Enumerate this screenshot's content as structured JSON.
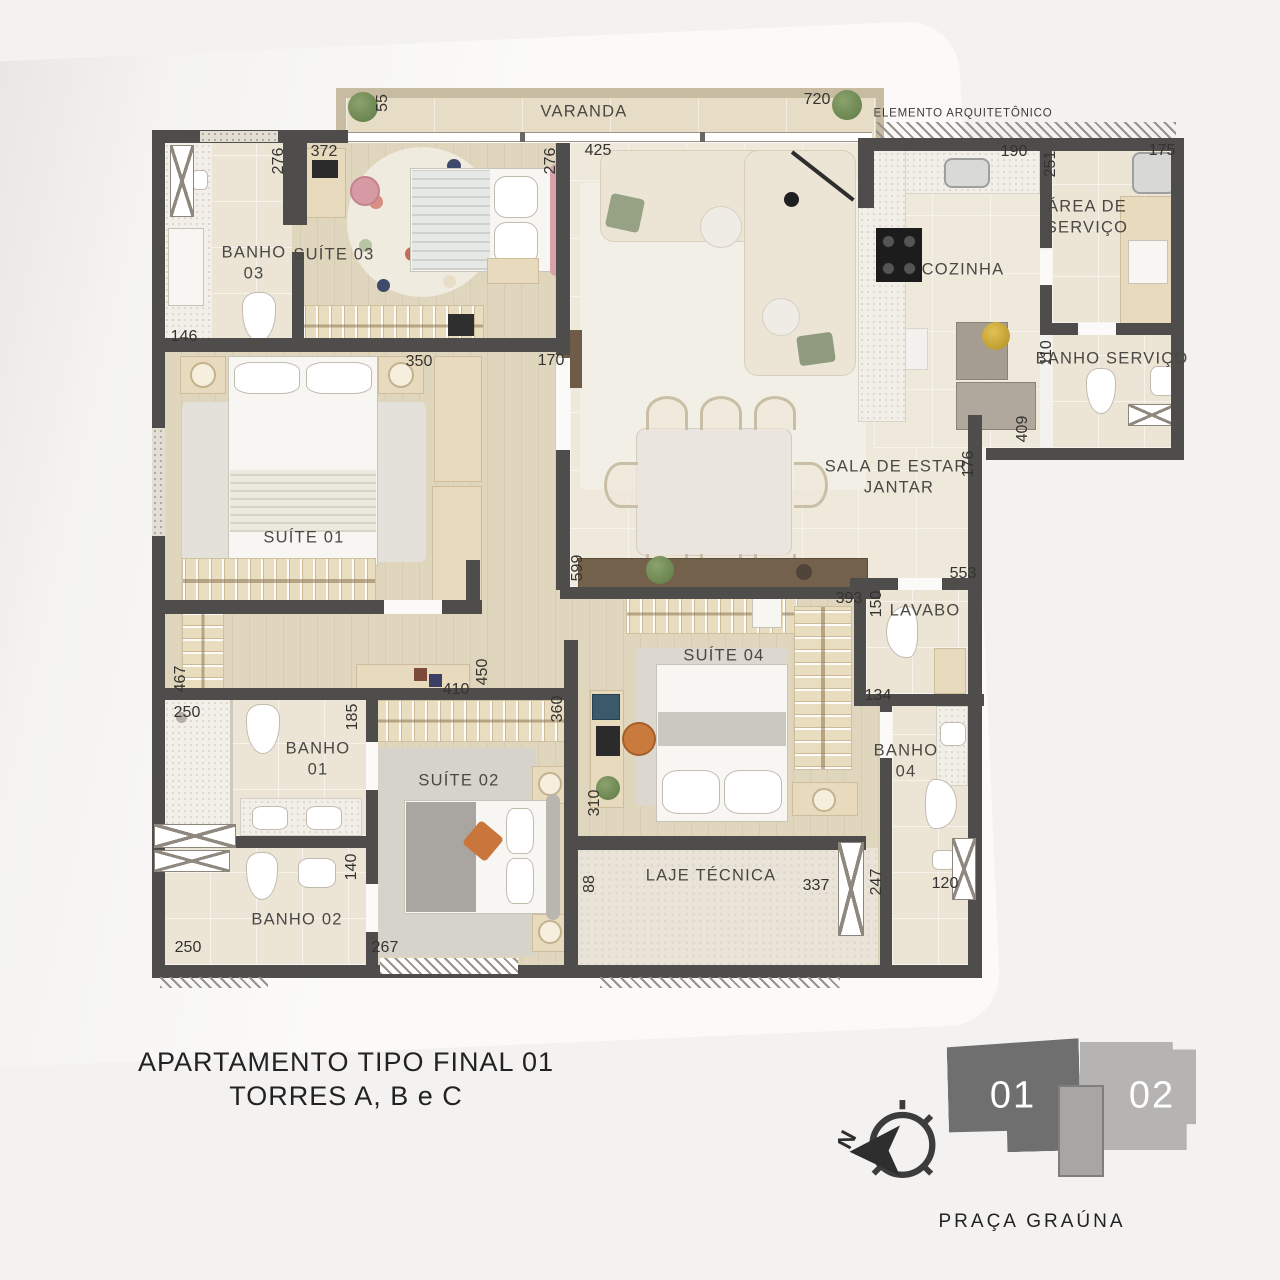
{
  "title": {
    "line1": "APARTAMENTO TIPO FINAL 01",
    "line2": "TORRES A, B e C"
  },
  "legend": {
    "caption": "PRAÇA GRAÚNA",
    "north_label": "N",
    "units": [
      {
        "id": "01"
      },
      {
        "id": "02"
      }
    ]
  },
  "colors": {
    "wall": "#4f4d4b",
    "wood_floor": "#e0d5bd",
    "tile_floor": "#ece5d5",
    "unit1": "#6f6f6f",
    "unit2": "#b5b4b3",
    "accent_pink": "#d79aa4",
    "accent_orange": "#c8763c"
  },
  "plan": {
    "room_labels": [
      {
        "name": "varanda",
        "lines": [
          "VARANDA"
        ],
        "x": 584,
        "y": 112
      },
      {
        "name": "elemento-arquitetonico",
        "lines": [
          "ELEMENTO ARQUITETÔNICO"
        ],
        "x": 963,
        "y": 114,
        "small": true
      },
      {
        "name": "banho-03",
        "lines": [
          "BANHO",
          "03"
        ],
        "x": 254,
        "y": 264
      },
      {
        "name": "suite-03",
        "lines": [
          "SUÍTE 03"
        ],
        "x": 334,
        "y": 255
      },
      {
        "name": "cozinha",
        "lines": [
          "COZINHA"
        ],
        "x": 963,
        "y": 270
      },
      {
        "name": "area-de-servico",
        "lines": [
          "ÁREA DE",
          "SERVIÇO"
        ],
        "x": 1087,
        "y": 218
      },
      {
        "name": "banho-servico",
        "lines": [
          "BANHO SERVIÇO"
        ],
        "x": 1112,
        "y": 359
      },
      {
        "name": "suite-01",
        "lines": [
          "SUÍTE 01"
        ],
        "x": 304,
        "y": 538
      },
      {
        "name": "sala-de-estar-jantar",
        "lines": [
          "SALA DE ESTAR/",
          "JANTAR"
        ],
        "x": 899,
        "y": 478
      },
      {
        "name": "lavabo",
        "lines": [
          "LAVABO"
        ],
        "x": 925,
        "y": 611
      },
      {
        "name": "suite-04",
        "lines": [
          "SUÍTE 04"
        ],
        "x": 724,
        "y": 656
      },
      {
        "name": "banho-01",
        "lines": [
          "BANHO",
          "01"
        ],
        "x": 318,
        "y": 760
      },
      {
        "name": "suite-02",
        "lines": [
          "SUÍTE 02"
        ],
        "x": 459,
        "y": 781
      },
      {
        "name": "banho-04",
        "lines": [
          "BANHO",
          "04"
        ],
        "x": 906,
        "y": 762
      },
      {
        "name": "banho-02",
        "lines": [
          "BANHO 02"
        ],
        "x": 297,
        "y": 920
      },
      {
        "name": "laje-tecnica",
        "lines": [
          "LAJE TÉCNICA"
        ],
        "x": 711,
        "y": 876
      }
    ],
    "dimensions": [
      {
        "t": "55",
        "x": 383,
        "y": 103,
        "v": true
      },
      {
        "t": "720",
        "x": 817,
        "y": 100,
        "v": false
      },
      {
        "t": "276",
        "x": 279,
        "y": 161,
        "v": true
      },
      {
        "t": "372",
        "x": 324,
        "y": 152,
        "v": false
      },
      {
        "t": "276",
        "x": 551,
        "y": 161,
        "v": true
      },
      {
        "t": "425",
        "x": 598,
        "y": 151,
        "v": false
      },
      {
        "t": "190",
        "x": 1014,
        "y": 152,
        "v": false
      },
      {
        "t": "251",
        "x": 1051,
        "y": 164,
        "v": true
      },
      {
        "t": "175",
        "x": 1162,
        "y": 151,
        "v": false
      },
      {
        "t": "146",
        "x": 184,
        "y": 337,
        "v": false
      },
      {
        "t": "350",
        "x": 419,
        "y": 362,
        "v": false
      },
      {
        "t": "170",
        "x": 551,
        "y": 361,
        "v": false
      },
      {
        "t": "110",
        "x": 1047,
        "y": 353,
        "v": true
      },
      {
        "t": "409",
        "x": 1023,
        "y": 429,
        "v": true
      },
      {
        "t": "176",
        "x": 969,
        "y": 464,
        "v": true
      },
      {
        "t": "599",
        "x": 578,
        "y": 568,
        "v": true
      },
      {
        "t": "553",
        "x": 963,
        "y": 574,
        "v": false
      },
      {
        "t": "393",
        "x": 849,
        "y": 599,
        "v": false
      },
      {
        "t": "150",
        "x": 877,
        "y": 604,
        "v": true
      },
      {
        "t": "134",
        "x": 878,
        "y": 696,
        "v": false
      },
      {
        "t": "467",
        "x": 181,
        "y": 679,
        "v": true
      },
      {
        "t": "250",
        "x": 187,
        "y": 713,
        "v": false
      },
      {
        "t": "185",
        "x": 353,
        "y": 717,
        "v": true
      },
      {
        "t": "450",
        "x": 483,
        "y": 672,
        "v": true
      },
      {
        "t": "410",
        "x": 456,
        "y": 690,
        "v": false
      },
      {
        "t": "360",
        "x": 558,
        "y": 709,
        "v": true
      },
      {
        "t": "310",
        "x": 595,
        "y": 803,
        "v": true
      },
      {
        "t": "88",
        "x": 590,
        "y": 884,
        "v": true
      },
      {
        "t": "337",
        "x": 816,
        "y": 886,
        "v": false
      },
      {
        "t": "247",
        "x": 877,
        "y": 882,
        "v": true
      },
      {
        "t": "120",
        "x": 945,
        "y": 884,
        "v": false
      },
      {
        "t": "140",
        "x": 352,
        "y": 867,
        "v": true
      },
      {
        "t": "250",
        "x": 188,
        "y": 948,
        "v": false
      },
      {
        "t": "267",
        "x": 385,
        "y": 948,
        "v": false
      }
    ]
  }
}
